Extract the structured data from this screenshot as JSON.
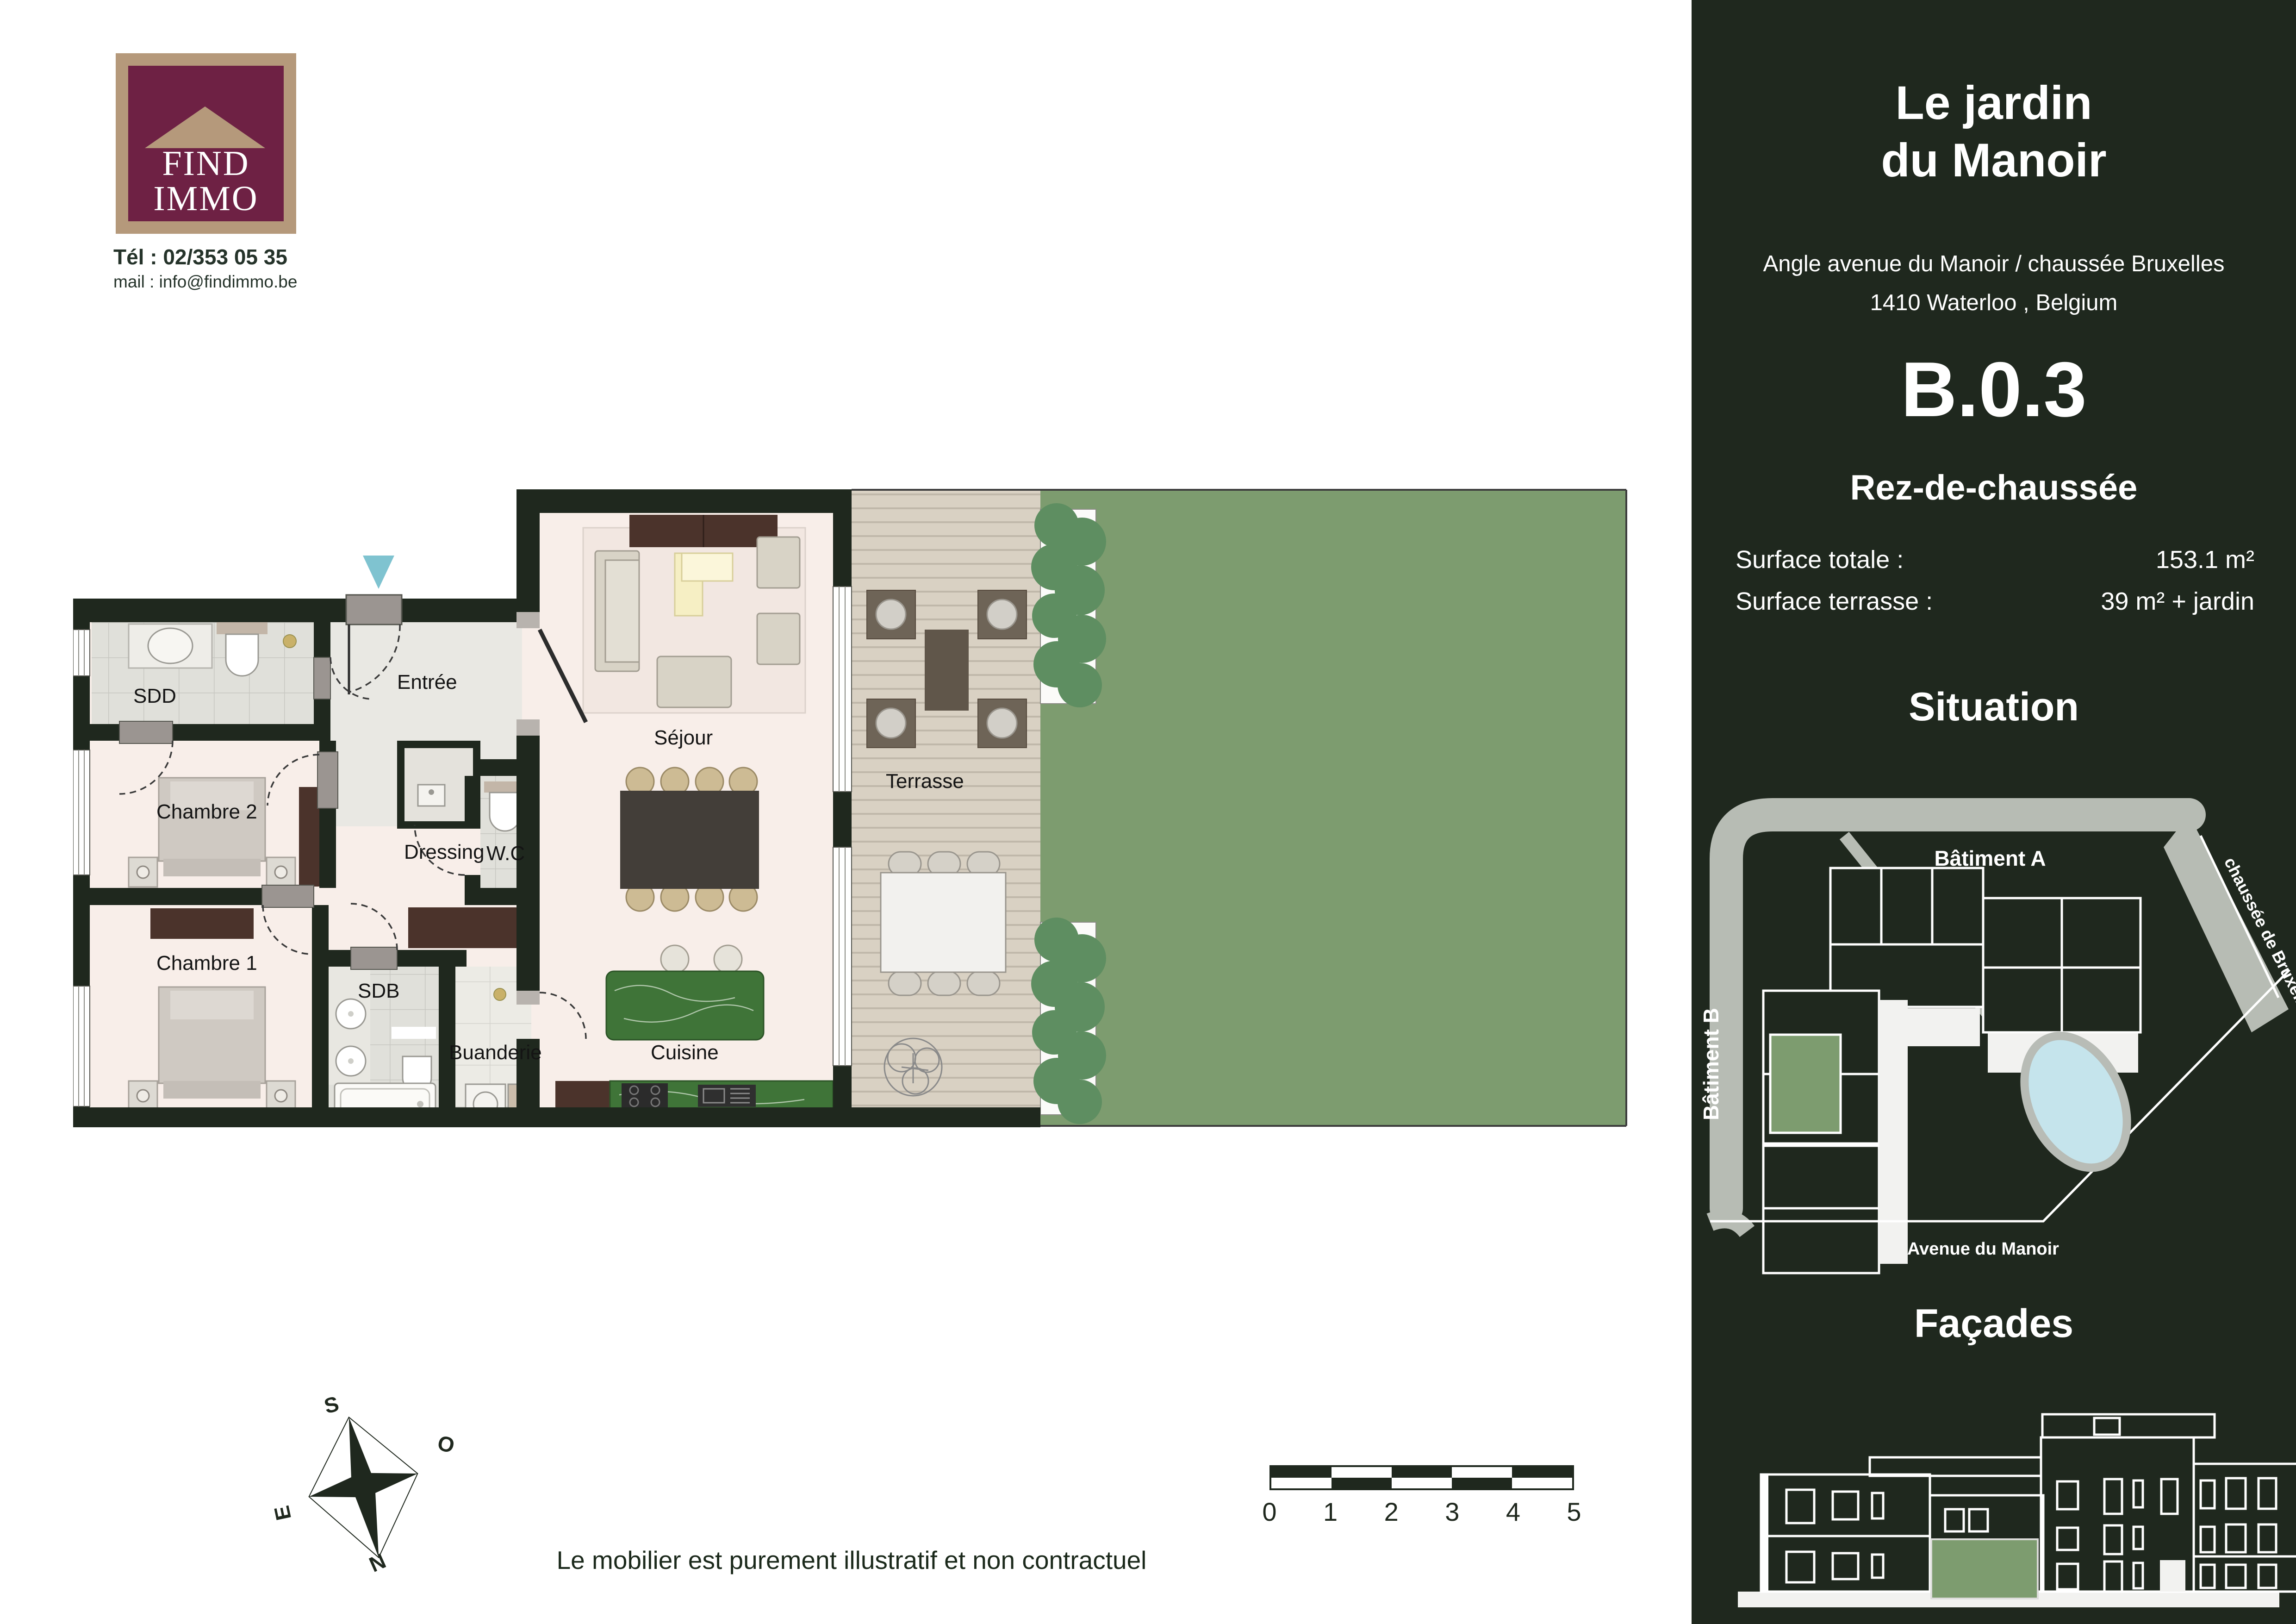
{
  "agency": {
    "logo_line1": "FIND",
    "logo_line2": "IMMO",
    "tel": "Tél : 02/353 05 35",
    "mail": "mail : info@findimmo.be"
  },
  "project": {
    "title_line1": "Le jardin",
    "title_line2": "du Manoir",
    "address_line1": "Angle avenue du Manoir / chaussée Bruxelles",
    "address_line2": "1410 Waterloo , Belgium",
    "unit": "B.0.3",
    "floor": "Rez-de-chaussée"
  },
  "surfaces": {
    "total_label": "Surface totale :",
    "total_value": "153.1 m²",
    "terrace_label": "Surface terrasse :",
    "terrace_value": "39 m² + jardin"
  },
  "situation": {
    "title": "Situation",
    "batiment_a": "Bâtiment A",
    "batiment_b": "Bâtiment B",
    "road_right": "chaussée de Bruxelles",
    "road_bottom": "Avenue du Manoir"
  },
  "facades": {
    "title": "Façades"
  },
  "plan": {
    "rooms": {
      "sdd": "SDD",
      "entree": "Entrée",
      "chambre2": "Chambre 2",
      "wc": "W.C",
      "dressing": "Dressing",
      "chambre1": "Chambre 1",
      "sdb": "SDB",
      "buanderie": "Buanderie",
      "sejour": "Séjour",
      "cuisine": "Cuisine",
      "terrasse": "Terrasse"
    }
  },
  "compass": {
    "n": "N",
    "s": "S",
    "e": "E",
    "o": "O"
  },
  "scalebar": {
    "labels": [
      "0",
      "1",
      "2",
      "3",
      "4",
      "5"
    ]
  },
  "footer": {
    "disclaimer": "Le mobilier est purement illustratif et non contractuel"
  },
  "colors": {
    "wall_green": "#1f281e",
    "garden_green": "#7d9c6f",
    "pond_blue": "#c5e4ec",
    "logo_maroon": "#6e2144",
    "logo_tan": "#b5997b",
    "marker_blue": "#7fc3d0"
  }
}
